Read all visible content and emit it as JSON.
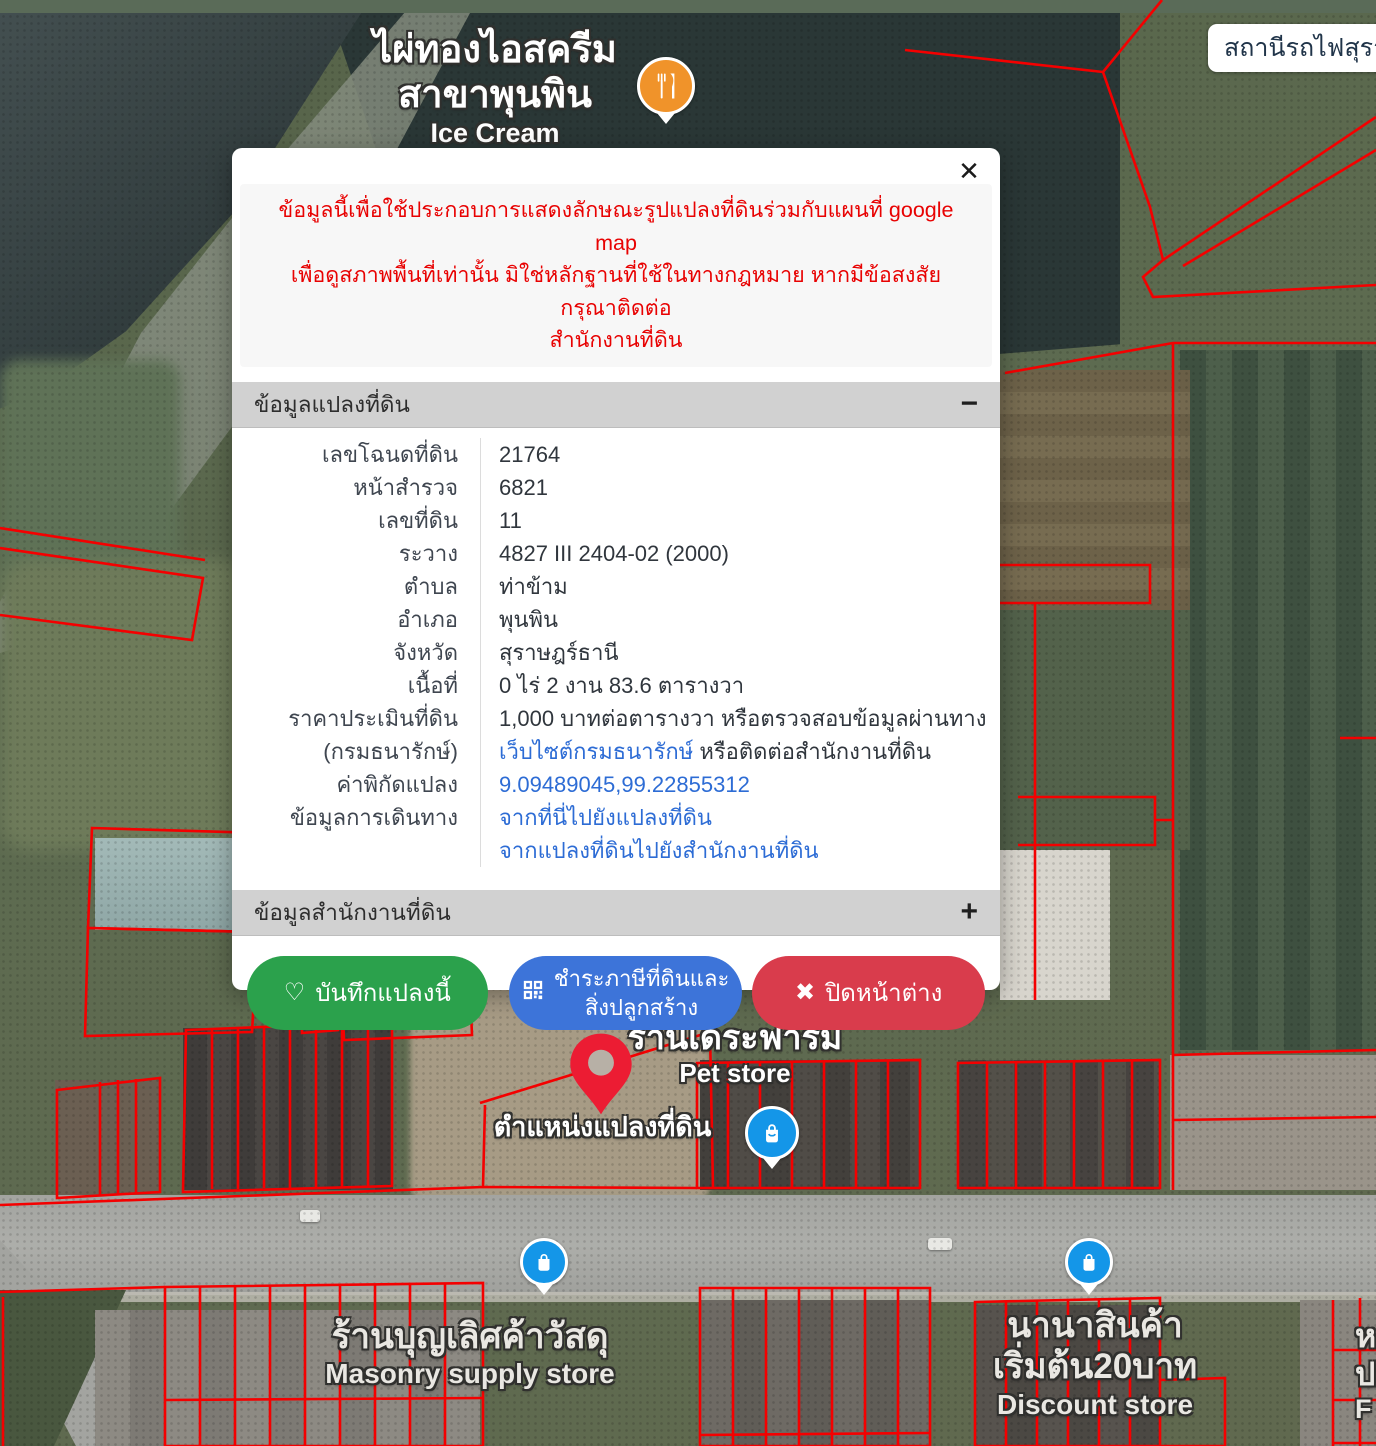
{
  "map": {
    "station_label": "สถานีรถไฟสุราษฎร์ธานี",
    "ice_cream": {
      "line1": "ไผ่ทองไอสครีม",
      "line2": "สาขาพุนพิน",
      "line3": "Ice Cream"
    },
    "pet_store": {
      "line1": "ร้านเดระฟาร์ม",
      "line2": "Pet store"
    },
    "pin_label": "ตำแหน่งแปลงที่ดิน",
    "masonry": {
      "line1": "ร้านบุญเลิศค้าวัสดุ",
      "line2": "Masonry supply store"
    },
    "discount": {
      "line1": "นานาสินค้า",
      "line2": "เริ่มต้น20บาท",
      "line3": "Discount store"
    },
    "edge_partial": {
      "line1": "ห",
      "line2": "ป",
      "line3": "F"
    },
    "colors": {
      "parcel_line": "#f40000",
      "topbar": "#0d2140",
      "poi_orange": "#f0932a",
      "poi_blue": "#1496e8",
      "pin_red": "#ec1c33"
    }
  },
  "modal": {
    "close_icon": "✕",
    "warning_lines": [
      "ข้อมูลนี้เพื่อใช้ประกอบการแสดงลักษณะรูปแปลงที่ดินร่วมกับแผนที่ google map",
      "เพื่อดูสภาพพื้นที่เท่านั้น มิใช่หลักฐานที่ใช้ในทางกฎหมาย หากมีข้อสงสัย กรุณาติดต่อ",
      "สำนักงานที่ดิน"
    ],
    "sections": [
      {
        "title": "ข้อมูลแปลงที่ดิน",
        "toggle": "−"
      },
      {
        "title": "ข้อมูลสำนักงานที่ดิน",
        "toggle": "+"
      }
    ],
    "rows": [
      {
        "label": "เลขโฉนดที่ดิน",
        "value": "21764"
      },
      {
        "label": "หน้าสำรวจ",
        "value": "6821"
      },
      {
        "label": "เลขที่ดิน",
        "value": "11"
      },
      {
        "label": "ระวาง",
        "value": "4827 III 2404-02 (2000)"
      },
      {
        "label": "ตำบล",
        "value": "ท่าข้าม"
      },
      {
        "label": "อำเภอ",
        "value": "พุนพิน"
      },
      {
        "label": "จังหวัด",
        "value": "สุราษฎร์ธานี"
      },
      {
        "label": "เนื้อที่",
        "value": "0 ไร่ 2 งาน 83.6 ตารางวา"
      },
      {
        "label": "ราคาประเมินที่ดิน",
        "label2": "(กรมธนารักษ์)",
        "value_pre": "1,000 บาทต่อตารางวา หรือตรวจสอบข้อมูลผ่านทาง",
        "value_link": "เว็บไซต์กรมธนารักษ์",
        "value_post": " หรือติดต่อสำนักงานที่ดิน"
      },
      {
        "label": "ค่าพิกัดแปลง",
        "link": "9.09489045,99.22855312"
      },
      {
        "label": "ข้อมูลการเดินทาง",
        "link1": "จากที่นี่ไปยังแปลงที่ดิน",
        "link2": "จากแปลงที่ดินไปยังสำนักงานที่ดิน"
      }
    ],
    "buttons": {
      "save": {
        "icon": "♡",
        "label": "บันทึกแปลงนี้"
      },
      "tax": {
        "label_line1": "ชำระภาษีที่ดินและ",
        "label_line2": "สิ่งปลูกสร้าง"
      },
      "close": {
        "icon": "✖",
        "label": "ปิดหน้าต่าง"
      }
    }
  }
}
